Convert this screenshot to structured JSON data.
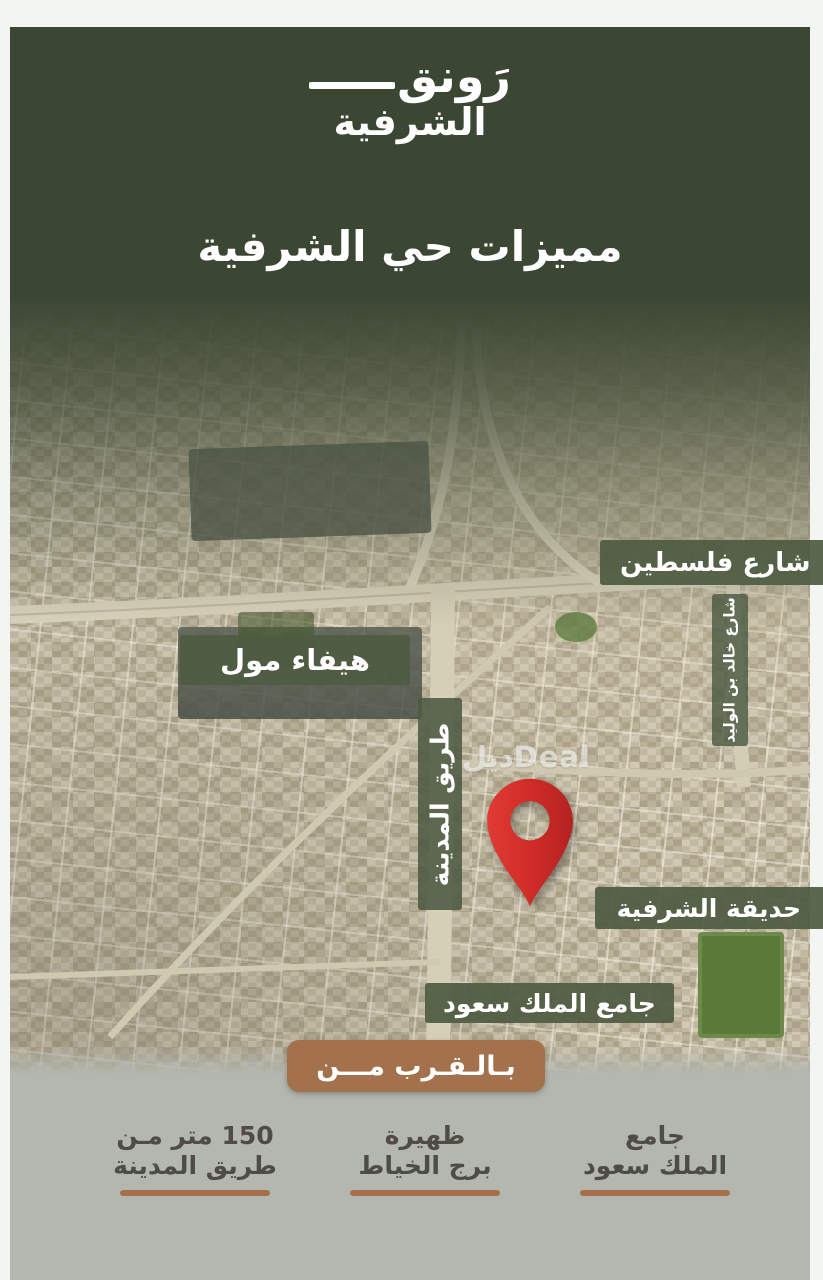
{
  "brand": {
    "name_line1": "رَونق",
    "name_line2": "الشرفية"
  },
  "heading": "مميزات حي الشرفية",
  "map": {
    "labels": {
      "palestine_street": "شارع فلسطين",
      "haifa_mall": "هيفاء مول",
      "madinah_road": "طريق المدينة",
      "khalid_bin_alwalid_street": "شارع خالد بن الوليد",
      "alsharafiyah_park": "حديقة الشرفية",
      "king_saud_mosque": "جامع الملك سعود"
    },
    "watermark": "ديلDeal"
  },
  "banner": {
    "label": "بـالـقـرب مـــن"
  },
  "nearby": {
    "items": [
      {
        "line1": "جامع",
        "line2": "الملك سعود"
      },
      {
        "line1": "ظهيرة",
        "line2": "برج الخياط"
      },
      {
        "line1": "150 متر مـن",
        "line2": "طريق المدينة"
      }
    ]
  },
  "colors": {
    "header_green": "#3c4733",
    "label_green": "#4f5b42",
    "banner_brown": "#a3714c",
    "underline_brown": "#a66f4a",
    "pin_red": "#ce2b28",
    "footer_bg": "#b3b7af",
    "footer_text": "#4e4c44",
    "frame_white": "#f3f5f3"
  }
}
